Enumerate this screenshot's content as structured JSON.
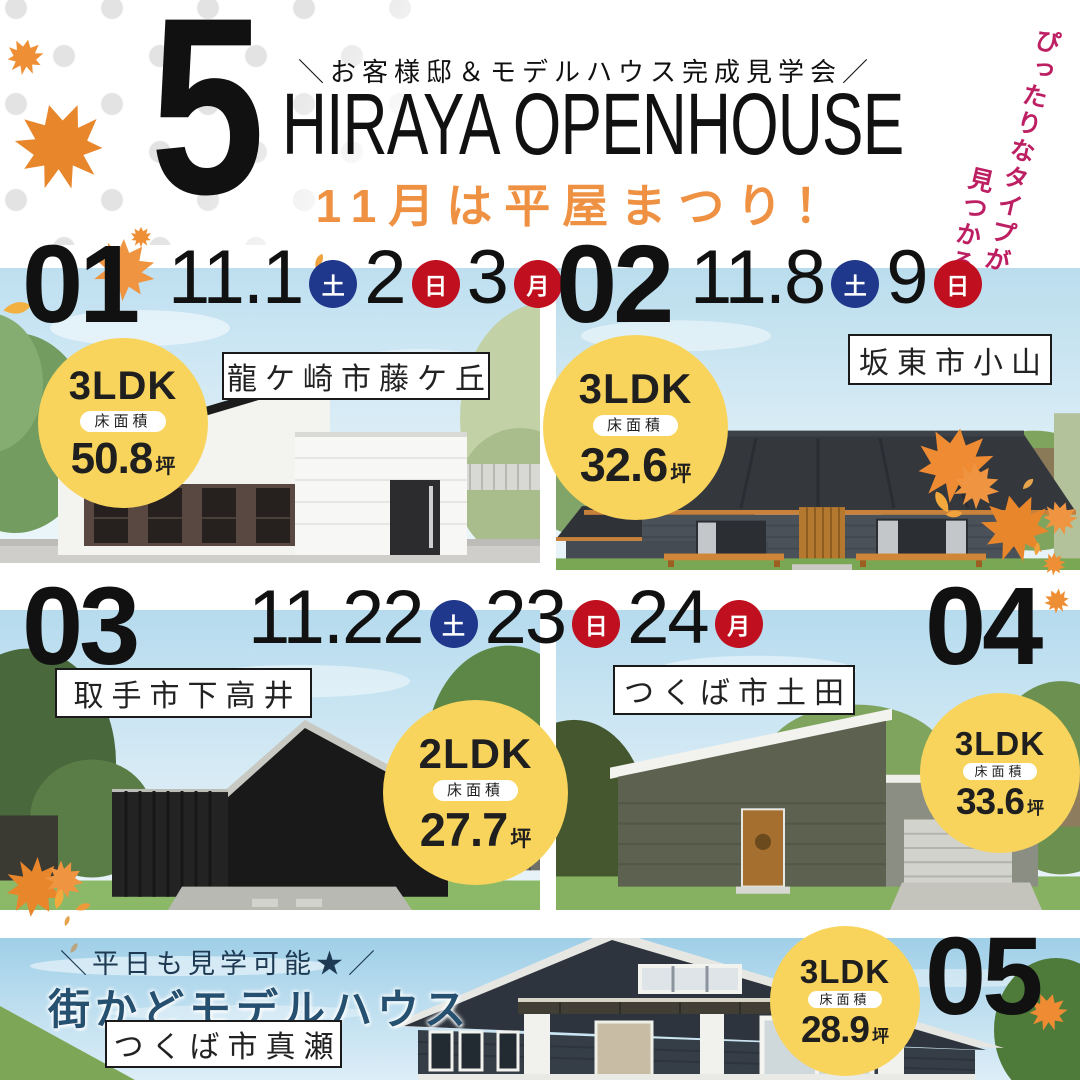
{
  "poster": {
    "big_number": "5",
    "tagline": "＼お客様邸＆モデルハウス完成見学会／",
    "title": "HIRAYA OPENHOUSE",
    "subtitle": "11月は平屋まつり！",
    "side_note": {
      "line1": "ぴったりなタイプが",
      "line2": "見つかる！"
    }
  },
  "colors": {
    "accent_orange": "#ef9143",
    "accent_magenta": "#bd1f63",
    "badge_yellow": "#f8d45c",
    "saturday_navy": "#20388c",
    "sunday_red": "#c00f1e",
    "bottom_navy": "#265070",
    "text_black": "#1a1a1a"
  },
  "listings": [
    {
      "number": "01",
      "location": "龍ケ崎市藤ケ丘",
      "layout": "3LDK",
      "area_label": "床面積",
      "area_value": "50.8",
      "area_unit": "坪",
      "dates": [
        {
          "text": "11.1",
          "kind": "num"
        },
        {
          "text": "土",
          "kind": "sat"
        },
        {
          "text": "2",
          "kind": "num"
        },
        {
          "text": "日",
          "kind": "sun"
        },
        {
          "text": "3",
          "kind": "num"
        },
        {
          "text": "月",
          "kind": "holiday"
        }
      ]
    },
    {
      "number": "02",
      "location": "坂東市小山",
      "layout": "3LDK",
      "area_label": "床面積",
      "area_value": "32.6",
      "area_unit": "坪",
      "dates": [
        {
          "text": "11.8",
          "kind": "num"
        },
        {
          "text": "土",
          "kind": "sat"
        },
        {
          "text": "9",
          "kind": "num"
        },
        {
          "text": "日",
          "kind": "sun"
        }
      ]
    },
    {
      "number": "03",
      "location": "取手市下高井",
      "layout": "2LDK",
      "area_label": "床面積",
      "area_value": "27.7",
      "area_unit": "坪",
      "dates": [
        {
          "text": "11.22",
          "kind": "num"
        },
        {
          "text": "土",
          "kind": "sat"
        },
        {
          "text": "23",
          "kind": "num"
        },
        {
          "text": "日",
          "kind": "sun"
        },
        {
          "text": "24",
          "kind": "num"
        },
        {
          "text": "月",
          "kind": "holiday"
        }
      ]
    },
    {
      "number": "04",
      "location": "つくば市土田",
      "layout": "3LDK",
      "area_label": "床面積",
      "area_value": "33.6",
      "area_unit": "坪",
      "dates": []
    },
    {
      "number": "05",
      "location": "つくば市真瀬",
      "layout": "3LDK",
      "area_label": "床面積",
      "area_value": "28.9",
      "area_unit": "坪",
      "dates": [],
      "note": "＼平日も見学可能★／",
      "model_label": "街かどモデルハウス"
    }
  ]
}
